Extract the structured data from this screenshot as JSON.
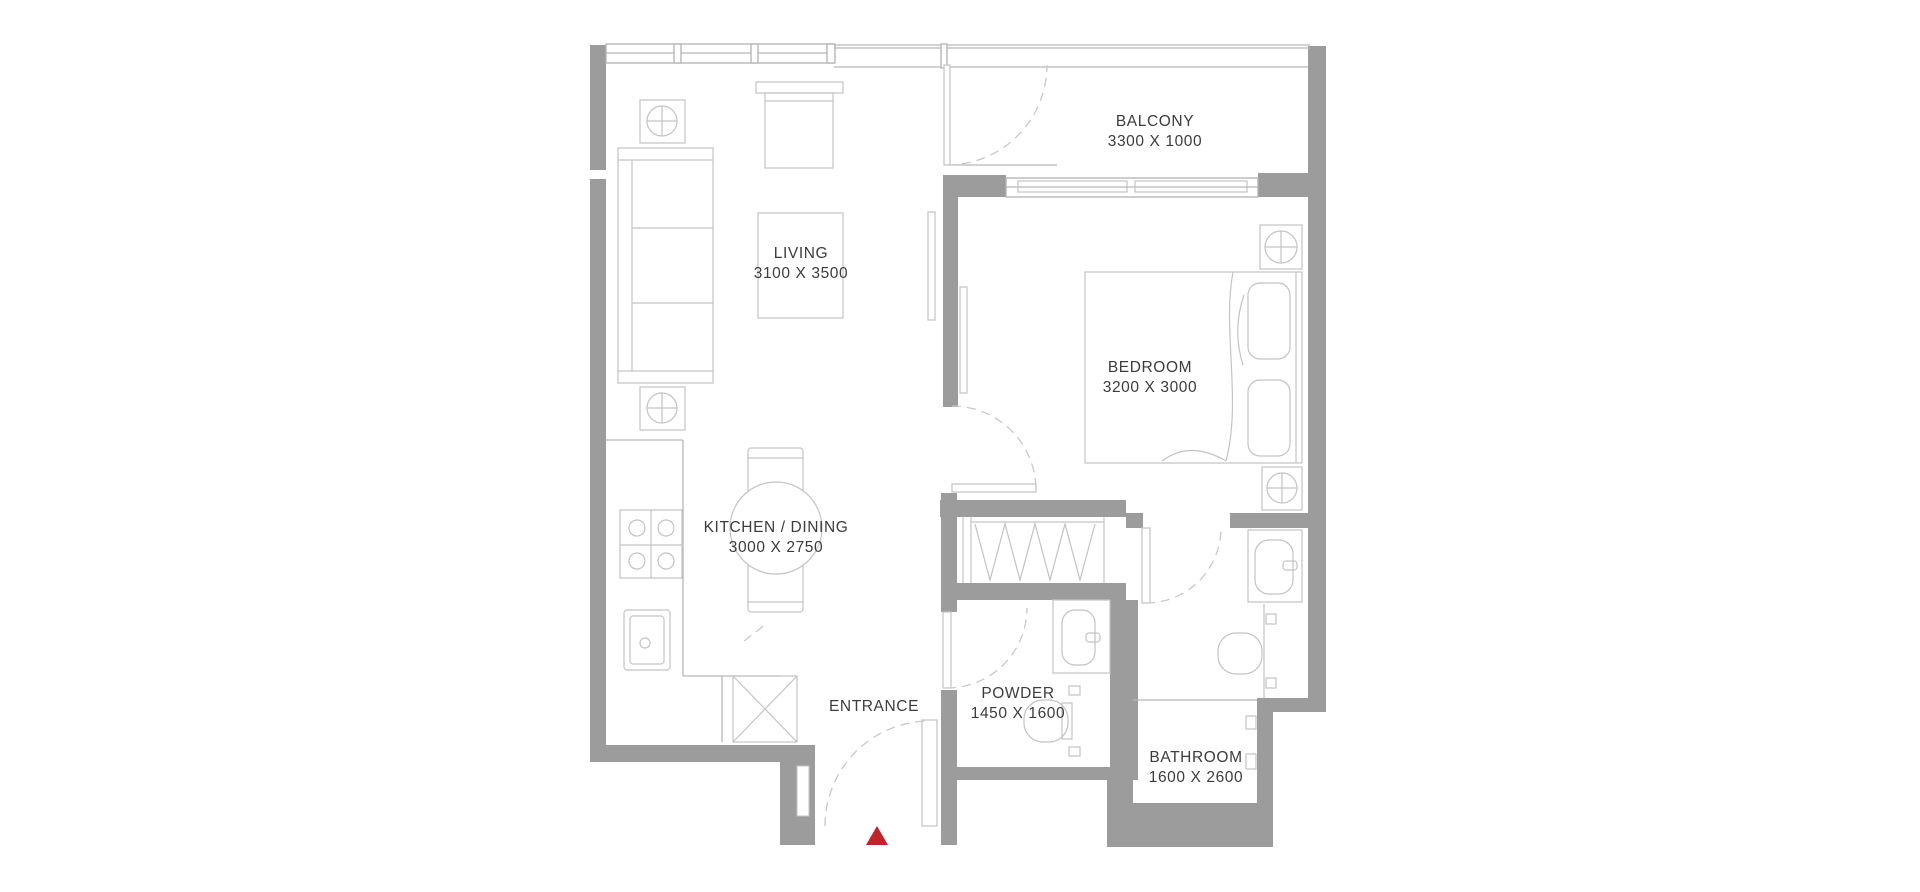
{
  "plan": {
    "title": "apartment-floor-plan",
    "rooms": {
      "balcony": {
        "name": "BALCONY",
        "dimensions": "3300 X 1000"
      },
      "living": {
        "name": "LIVING",
        "dimensions": "3100 X 3500"
      },
      "bedroom": {
        "name": "BEDROOM",
        "dimensions": "3200 X 3000"
      },
      "kitchen_dining": {
        "name": "KITCHEN / DINING",
        "dimensions": "3000 X 2750"
      },
      "powder": {
        "name": "POWDER",
        "dimensions": "1450 X 1600"
      },
      "bathroom": {
        "name": "BATHROOM",
        "dimensions": "1600 X 2600"
      },
      "entrance": {
        "name": "ENTRANCE"
      }
    },
    "colors": {
      "wall": "#9c9c9c",
      "furniture_line": "#c3c3c3",
      "text": "#3c3c3c",
      "entrance_marker": "#c4222a",
      "background": "#ffffff"
    }
  }
}
